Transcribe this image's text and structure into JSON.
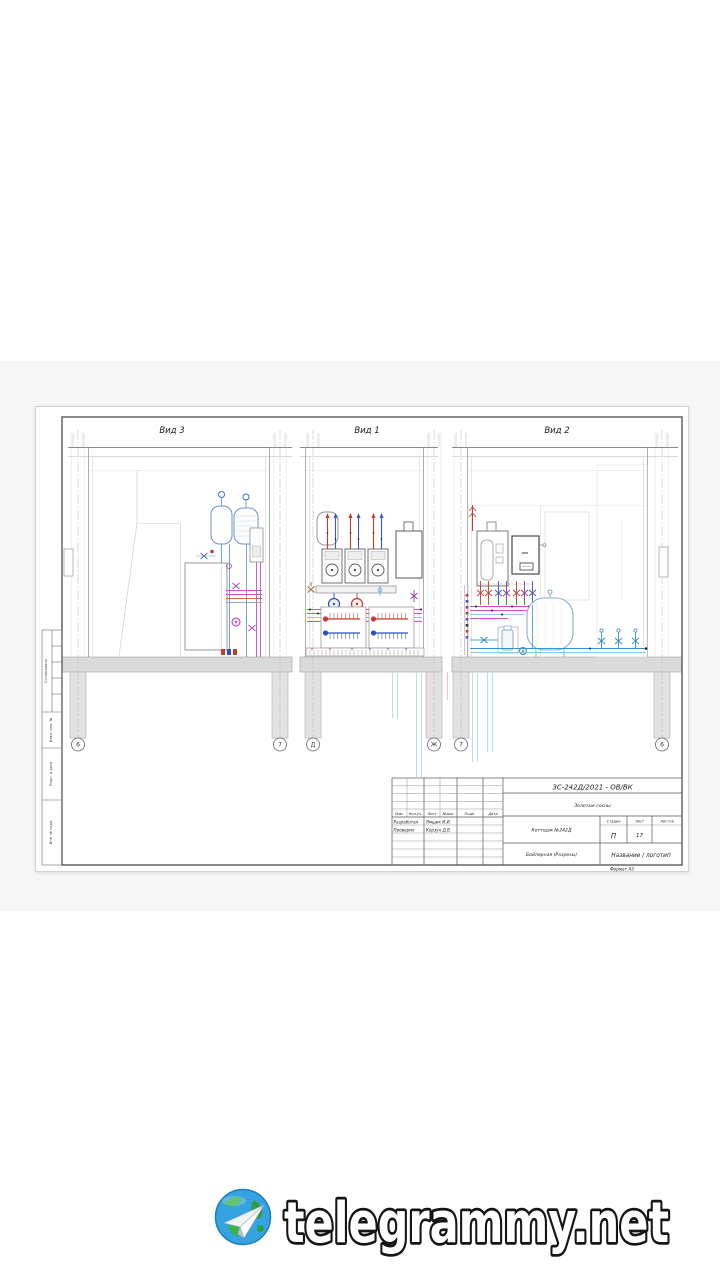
{
  "watermark": {
    "text": "telegrammy.net",
    "icon": "globe-paper-plane-icon"
  },
  "sheet": {
    "views": [
      {
        "label": "Вид 3"
      },
      {
        "label": "Вид 1"
      },
      {
        "label": "Вид 2"
      }
    ],
    "grid_markers": [
      "6",
      "7",
      "Д",
      "Ж",
      "7",
      "6"
    ],
    "side_strip_labels": [
      "Согласовано",
      "Взам. инв. №",
      "Подп. и дата",
      "Инв. № подл."
    ],
    "title_block": {
      "doc_code": "ЗС-242Д/2021 - ОВ/ВК",
      "project_name": "Золотые сосны",
      "object_name": "Коттедж №242Д",
      "drawing_title": "Бойлерная (Разрезы)",
      "company": "Название / логотип",
      "stage_label": "Стадия",
      "sheet_label": "Лист",
      "sheets_total_label": "Листов",
      "stage_value": "П",
      "sheet_value": "17",
      "header_cols": [
        "Изм.",
        "Кол.уч.",
        "Лист",
        "№док.",
        "Подп.",
        "Дата"
      ],
      "signature_rows": [
        {
          "role": "Разработал",
          "name": "Ямщик И.И."
        },
        {
          "role": "Проверил",
          "name": "Корзун Д.В."
        }
      ],
      "format_note": "Формат А3"
    },
    "colors": {
      "pipe_hot": "#c23b2e",
      "pipe_cold": "#2f4ec2",
      "pipe_heating": "#cc4fcf",
      "pipe_water": "#53a7d8",
      "pipe_drain": "#b7dff0",
      "slab": "#dadada",
      "frame": "#4a4a4a"
    }
  }
}
